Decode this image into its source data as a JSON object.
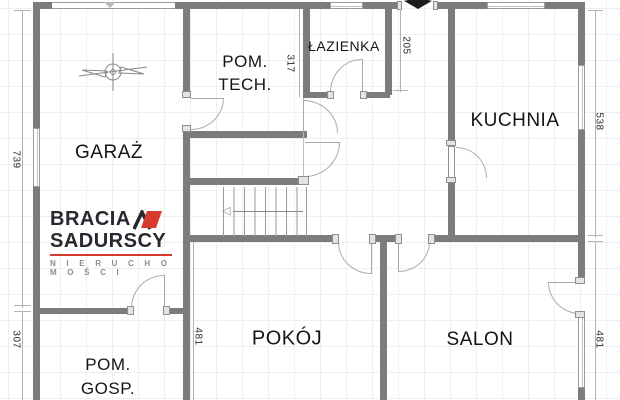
{
  "rooms": {
    "garaz": {
      "label": "GARAŻ"
    },
    "pom_tech": {
      "line1": "POM.",
      "line2": "TECH."
    },
    "lazienka": {
      "label": "ŁAZIENKA"
    },
    "kuchnia": {
      "label": "KUCHNIA"
    },
    "pokoj": {
      "label": "POKÓJ"
    },
    "salon": {
      "label": "SALON"
    },
    "pom_gosp": {
      "line1": "POM.",
      "line2": "GOSP."
    }
  },
  "dimensions": {
    "left_top": "739",
    "left_bottom": "307",
    "lazienka_left": "317",
    "lazienka_right": "205",
    "right_top": "538",
    "right_bottom": "481",
    "pokoj_left": "481"
  },
  "logo": {
    "brand_line1": "BRACIA",
    "brand_line2": "SADURSCY",
    "tagline": "N I E R U C H O M O Ś C I"
  },
  "colors": {
    "wall": "#7c7c7c",
    "logo_red": "#d63a2f",
    "logo_dark": "#28282f",
    "room_text": "#151515",
    "entry_marker": "#1c1c1c"
  },
  "stairs_arrow": "◁"
}
